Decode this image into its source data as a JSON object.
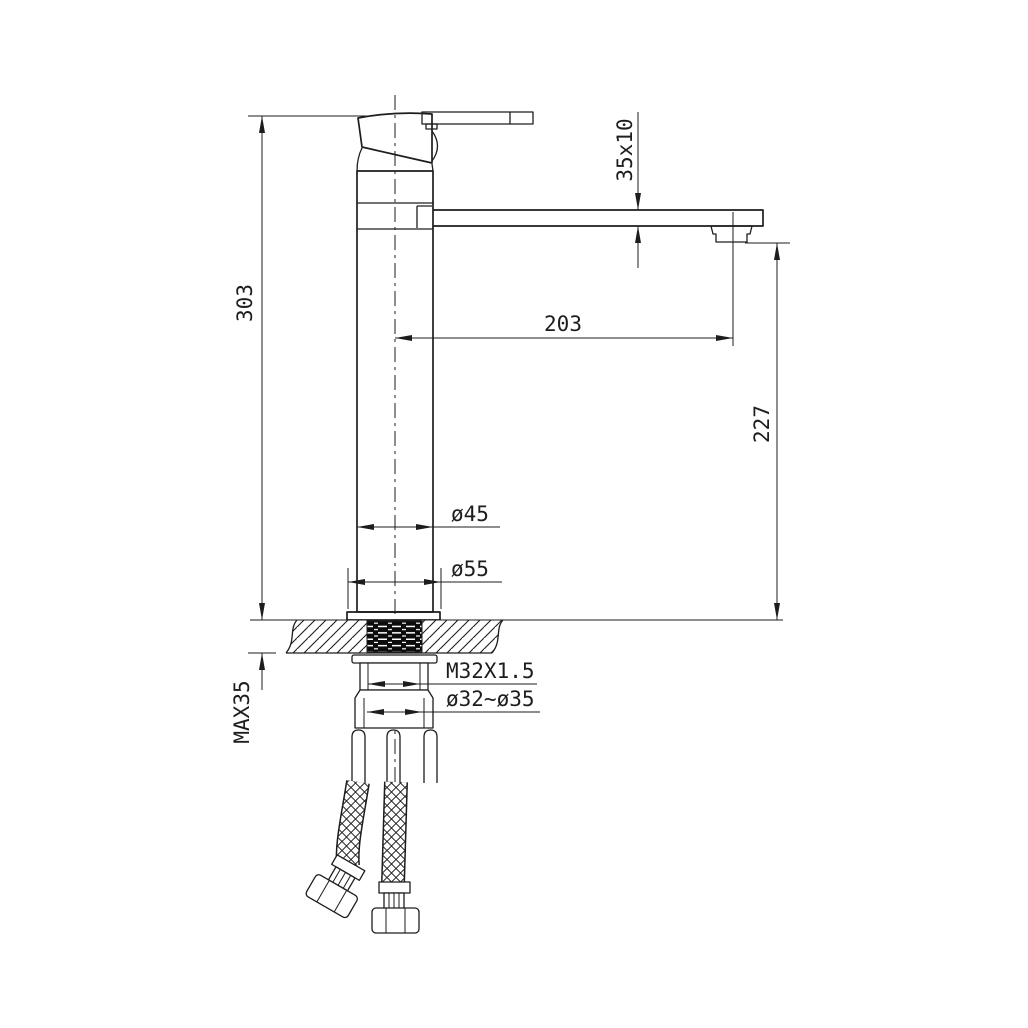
{
  "page": {
    "background": "#ffffff",
    "line_color": "#1d1d1d",
    "description": "Technical installation drawing of a tall single-lever kitchen/basin mixer faucet with flexible supply hoses"
  },
  "drawing": {
    "labels": {
      "overall_height": "303",
      "spout_profile": "35x10",
      "spout_reach": "203",
      "outlet_height": "227",
      "body_diameter": "ø45",
      "base_diameter": "ø55",
      "shank_thread": "M32X1.5",
      "mounting_hole": "ø32~ø35",
      "max_deck_thickness": "MAX35"
    }
  }
}
